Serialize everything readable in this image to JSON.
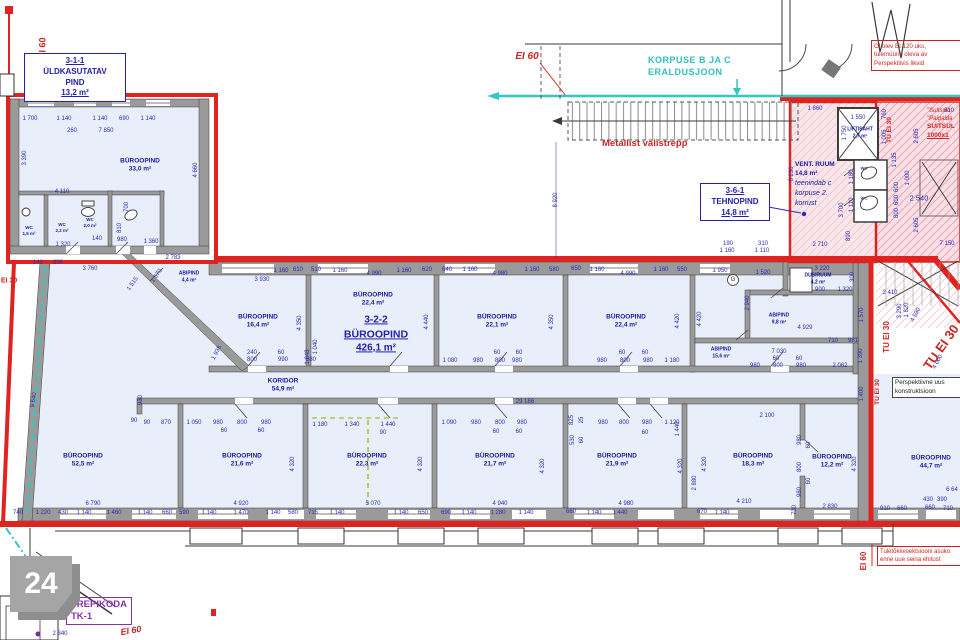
{
  "drawing": {
    "sheet_number": "24"
  },
  "boxed": {
    "uld": [
      "3-1-1",
      "ÜLDKASUTATAV",
      "PIND",
      "13,2 m²"
    ],
    "teh": [
      "3-6-1",
      "TEHNOPIND",
      "14,8 m²"
    ]
  },
  "big_label": {
    "code": "3-2-2",
    "name": "BÜROOPIND",
    "area": "426,1 m²"
  },
  "vent": {
    "name": "VENT. RUUM",
    "area": "14,8 m²",
    "notes": [
      "teenindab c",
      "korpuse 2.",
      "korrust"
    ]
  },
  "notes": {
    "korpuse": [
      "KORPUSE B JA C",
      "ERALDUSJOON"
    ],
    "metallist": "Metallist välistrepp",
    "ololev": [
      "Ol olev EI 120 uks,",
      "tulemüüris oleva av",
      "Perspektiivis likvid"
    ],
    "suitsu": [
      "\"Suitsulu",
      "\"Paigalda",
      "SUITSUL",
      "1000x1"
    ],
    "persp": [
      "Perspektiivne uus",
      "konstruktsioon"
    ],
    "tuletokke": [
      "Tuletõkkesektsiooni asuko",
      "enne uue seina ehitust"
    ],
    "trepikoda": [
      "TREPIKODA",
      "TK-1"
    ]
  },
  "rooms": [
    {
      "name": "BÜROOPIND",
      "area": "33,0 m²",
      "x": 140,
      "y": 166
    },
    {
      "name": "WC",
      "area": "1,5 m²",
      "x": 29,
      "y": 231,
      "f": 4.5
    },
    {
      "name": "WC",
      "area": "2,2 m²",
      "x": 62,
      "y": 228,
      "f": 4.5
    },
    {
      "name": "WC",
      "area": "2,0 m²",
      "x": 90,
      "y": 223,
      "f": 4.5
    },
    {
      "name": "ABIPIND",
      "area": "4,4 m²",
      "x": 189,
      "y": 277,
      "f": 5
    },
    {
      "name": "BÜROOPIND",
      "area": "16,4 m²",
      "x": 258,
      "y": 322
    },
    {
      "name": "BÜROOPIND",
      "area": "22,4 m²",
      "x": 373,
      "y": 300
    },
    {
      "name": "BÜROOPIND",
      "area": "22,1 m²",
      "x": 497,
      "y": 322
    },
    {
      "name": "BÜROOPIND",
      "area": "22,4 m²",
      "x": 626,
      "y": 322
    },
    {
      "name": "DUSIRUUM",
      "area": "4,2 m²",
      "x": 818,
      "y": 279,
      "f": 5
    },
    {
      "name": "ABIPIND",
      "area": "9,8 m²",
      "x": 779,
      "y": 319,
      "f": 5
    },
    {
      "name": "ABIPIND",
      "area": "15,6 m²",
      "x": 721,
      "y": 353,
      "f": 5
    },
    {
      "name": "KORIDOR",
      "area": "54,9 m²",
      "x": 283,
      "y": 386
    },
    {
      "name": "BÜROOPIND",
      "area": "52,5 m²",
      "x": 83,
      "y": 461
    },
    {
      "name": "BÜROOPIND",
      "area": "21,6 m²",
      "x": 242,
      "y": 461
    },
    {
      "name": "BÜROOPIND",
      "area": "22,3 m²",
      "x": 367,
      "y": 461
    },
    {
      "name": "BÜROOPIND",
      "area": "21,7 m²",
      "x": 495,
      "y": 461
    },
    {
      "name": "BÜROOPIND",
      "area": "21,9 m²",
      "x": 617,
      "y": 461
    },
    {
      "name": "BÜROOPIND",
      "area": "18,3 m²",
      "x": 753,
      "y": 461
    },
    {
      "name": "BÜROOPIND",
      "area": "12,2 m²",
      "x": 832,
      "y": 462
    },
    {
      "name": "BÜROOPIND",
      "area": "44,7 m²",
      "x": 931,
      "y": 463
    },
    {
      "name": "LIFTISAHT",
      "area": "2,7 m²",
      "x": 860,
      "y": 133,
      "f": 5
    },
    {
      "name": "WC",
      "area": "",
      "x": 864,
      "y": 168,
      "f": 4
    },
    {
      "name": "WC",
      "area": "",
      "x": 864,
      "y": 198,
      "f": 4
    }
  ],
  "fire_labels": [
    {
      "t": "EI 60",
      "x": 43,
      "y": 48,
      "r": -90,
      "f": 9
    },
    {
      "t": "EI 30",
      "x": 9,
      "y": 281,
      "f": 7
    },
    {
      "t": "EI 60",
      "x": 527,
      "y": 57,
      "f": 10,
      "i": 1
    },
    {
      "t": "TU EI 30",
      "x": 890,
      "y": 130,
      "r": -90,
      "f": 6.5
    },
    {
      "t": "TU EI 30",
      "x": 887,
      "y": 337,
      "r": -90,
      "f": 8
    },
    {
      "t": "TU EI 30",
      "x": 878,
      "y": 392,
      "r": -90,
      "f": 6.5
    },
    {
      "t": "TU EI 30",
      "x": 941,
      "y": 347,
      "r": -55,
      "f": 13
    },
    {
      "t": "EI 60",
      "x": 864,
      "y": 561,
      "r": -90,
      "f": 8
    },
    {
      "t": "EI 60",
      "x": 131,
      "y": 631,
      "r": -10,
      "f": 9,
      "i": 1
    }
  ],
  "dimensions": [
    {
      "t": "1 700",
      "x": 30,
      "y": 119
    },
    {
      "t": "1 140",
      "x": 64,
      "y": 119
    },
    {
      "t": "1 140",
      "x": 100,
      "y": 119
    },
    {
      "t": "690",
      "x": 124,
      "y": 119
    },
    {
      "t": "1 140",
      "x": 148,
      "y": 119
    },
    {
      "t": "260",
      "x": 72,
      "y": 131
    },
    {
      "t": "7 850",
      "x": 106,
      "y": 131
    },
    {
      "t": "3 390",
      "x": 25,
      "y": 158,
      "r": -90
    },
    {
      "t": "4 660",
      "x": 196,
      "y": 170,
      "r": -90
    },
    {
      "t": "4 110",
      "x": 62,
      "y": 192
    },
    {
      "t": "700",
      "x": 127,
      "y": 207,
      "r": -90
    },
    {
      "t": "810",
      "x": 120,
      "y": 228,
      "r": -90
    },
    {
      "t": "140",
      "x": 97,
      "y": 239
    },
    {
      "t": "980",
      "x": 122,
      "y": 240
    },
    {
      "t": "1 360",
      "x": 151,
      "y": 242
    },
    {
      "t": "1 320",
      "x": 63,
      "y": 245
    },
    {
      "t": "890",
      "x": 58,
      "y": 263
    },
    {
      "t": "140",
      "x": 38,
      "y": 263
    },
    {
      "t": "2 783",
      "x": 173,
      "y": 258
    },
    {
      "t": "3 760",
      "x": 90,
      "y": 269
    },
    {
      "t": "1 515",
      "x": 133,
      "y": 284,
      "r": -55
    },
    {
      "t": "1 570",
      "x": 157,
      "y": 276,
      "r": -55
    },
    {
      "t": "1 938",
      "x": 217,
      "y": 353,
      "r": -62
    },
    {
      "t": "9 640",
      "x": 34,
      "y": 400,
      "r": -82
    },
    {
      "t": "930",
      "x": 141,
      "y": 400,
      "r": -90
    },
    {
      "t": "3 930",
      "x": 262,
      "y": 280
    },
    {
      "t": "1 160",
      "x": 281,
      "y": 271
    },
    {
      "t": "610",
      "x": 298,
      "y": 270
    },
    {
      "t": "510",
      "x": 316,
      "y": 270
    },
    {
      "t": "1 160",
      "x": 340,
      "y": 271
    },
    {
      "t": "4 990",
      "x": 374,
      "y": 274
    },
    {
      "t": "1 160",
      "x": 404,
      "y": 271
    },
    {
      "t": "620",
      "x": 427,
      "y": 270
    },
    {
      "t": "640",
      "x": 447,
      "y": 270
    },
    {
      "t": "1 160",
      "x": 470,
      "y": 270
    },
    {
      "t": "4 980",
      "x": 500,
      "y": 274
    },
    {
      "t": "1 160",
      "x": 532,
      "y": 270
    },
    {
      "t": "580",
      "x": 554,
      "y": 270
    },
    {
      "t": "650",
      "x": 576,
      "y": 269
    },
    {
      "t": "1 160",
      "x": 597,
      "y": 270
    },
    {
      "t": "4 990",
      "x": 628,
      "y": 274
    },
    {
      "t": "1 160",
      "x": 661,
      "y": 270
    },
    {
      "t": "550",
      "x": 682,
      "y": 270
    },
    {
      "t": "1 950",
      "x": 720,
      "y": 271
    },
    {
      "t": "1 520",
      "x": 763,
      "y": 273
    },
    {
      "t": "3 220",
      "x": 822,
      "y": 269
    },
    {
      "t": "300",
      "x": 853,
      "y": 277,
      "r": -90
    },
    {
      "t": "900",
      "x": 820,
      "y": 290
    },
    {
      "t": "1 320",
      "x": 845,
      "y": 290
    },
    {
      "t": "2 940",
      "x": 748,
      "y": 303,
      "r": -90
    },
    {
      "t": "190",
      "x": 728,
      "y": 244
    },
    {
      "t": "310",
      "x": 763,
      "y": 244
    },
    {
      "t": "1 160",
      "x": 727,
      "y": 251
    },
    {
      "t": "1 110",
      "x": 762,
      "y": 251
    },
    {
      "t": "4 350",
      "x": 300,
      "y": 323,
      "r": -90
    },
    {
      "t": "4 440",
      "x": 427,
      "y": 322,
      "r": -90
    },
    {
      "t": "4 350",
      "x": 552,
      "y": 322,
      "r": -90
    },
    {
      "t": "4 420",
      "x": 678,
      "y": 321,
      "r": -90
    },
    {
      "t": "4 420",
      "x": 700,
      "y": 319,
      "r": -90
    },
    {
      "t": "240",
      "x": 252,
      "y": 353
    },
    {
      "t": "60",
      "x": 281,
      "y": 353
    },
    {
      "t": "800",
      "x": 252,
      "y": 360
    },
    {
      "t": "990",
      "x": 283,
      "y": 360
    },
    {
      "t": "580",
      "x": 311,
      "y": 360
    },
    {
      "t": "1 040",
      "x": 316,
      "y": 347,
      "r": -90
    },
    {
      "t": "1 048",
      "x": 308,
      "y": 357,
      "r": -90
    },
    {
      "t": "1 080",
      "x": 450,
      "y": 361
    },
    {
      "t": "980",
      "x": 478,
      "y": 361
    },
    {
      "t": "800",
      "x": 500,
      "y": 361
    },
    {
      "t": "980",
      "x": 517,
      "y": 361
    },
    {
      "t": "60",
      "x": 497,
      "y": 353
    },
    {
      "t": "60",
      "x": 519,
      "y": 353
    },
    {
      "t": "980",
      "x": 602,
      "y": 361
    },
    {
      "t": "800",
      "x": 625,
      "y": 361
    },
    {
      "t": "980",
      "x": 648,
      "y": 361
    },
    {
      "t": "1 180",
      "x": 672,
      "y": 361
    },
    {
      "t": "60",
      "x": 622,
      "y": 353
    },
    {
      "t": "60",
      "x": 645,
      "y": 353
    },
    {
      "t": "4 929",
      "x": 805,
      "y": 328
    },
    {
      "t": "710",
      "x": 833,
      "y": 341
    },
    {
      "t": "981",
      "x": 853,
      "y": 341
    },
    {
      "t": "7 030",
      "x": 779,
      "y": 352
    },
    {
      "t": "60",
      "x": 776,
      "y": 359
    },
    {
      "t": "60",
      "x": 799,
      "y": 359
    },
    {
      "t": "980",
      "x": 755,
      "y": 366
    },
    {
      "t": "800",
      "x": 778,
      "y": 366
    },
    {
      "t": "980",
      "x": 801,
      "y": 366
    },
    {
      "t": "2 062",
      "x": 840,
      "y": 366
    },
    {
      "t": "2 410",
      "x": 890,
      "y": 293
    },
    {
      "t": "3 290",
      "x": 900,
      "y": 311,
      "r": -90
    },
    {
      "t": "1 820",
      "x": 907,
      "y": 310,
      "r": -90
    },
    {
      "t": "4 590",
      "x": 916,
      "y": 315,
      "r": -62
    },
    {
      "t": "4 000",
      "x": 938,
      "y": 362,
      "r": -62
    },
    {
      "t": "1 570",
      "x": 862,
      "y": 315,
      "r": -90
    },
    {
      "t": "1 390",
      "x": 861,
      "y": 356,
      "r": -90
    },
    {
      "t": "1 400",
      "x": 862,
      "y": 394,
      "r": -90
    },
    {
      "t": "7 150",
      "x": 947,
      "y": 244
    },
    {
      "t": "2 540",
      "x": 919,
      "y": 198,
      "f": 7.5
    },
    {
      "t": "2 605",
      "x": 917,
      "y": 136,
      "r": -90
    },
    {
      "t": "2 605",
      "x": 917,
      "y": 225,
      "r": -90
    },
    {
      "t": "1 000",
      "x": 908,
      "y": 178,
      "r": -90
    },
    {
      "t": "760",
      "x": 885,
      "y": 114,
      "r": -90
    },
    {
      "t": "1 005",
      "x": 885,
      "y": 137,
      "r": -90
    },
    {
      "t": "1 135",
      "x": 895,
      "y": 160,
      "r": -90
    },
    {
      "t": "600",
      "x": 897,
      "y": 187,
      "r": -90
    },
    {
      "t": "600",
      "x": 897,
      "y": 200,
      "r": -90
    },
    {
      "t": "800",
      "x": 897,
      "y": 213,
      "r": -90
    },
    {
      "t": "610",
      "x": 949,
      "y": 111
    },
    {
      "t": "1 860",
      "x": 815,
      "y": 109
    },
    {
      "t": "1 550",
      "x": 858,
      "y": 118
    },
    {
      "t": "1 750",
      "x": 845,
      "y": 133,
      "r": -90
    },
    {
      "t": "6 230",
      "x": 792,
      "y": 174,
      "r": -90
    },
    {
      "t": "2 710",
      "x": 820,
      "y": 245
    },
    {
      "t": "3 700",
      "x": 842,
      "y": 210,
      "r": -90
    },
    {
      "t": "1 180",
      "x": 852,
      "y": 177,
      "r": -90
    },
    {
      "t": "1 110",
      "x": 852,
      "y": 205,
      "r": -90
    },
    {
      "t": "890",
      "x": 849,
      "y": 236,
      "r": -90
    },
    {
      "t": "8 920",
      "x": 556,
      "y": 200,
      "r": -90
    },
    {
      "t": "29 166",
      "x": 525,
      "y": 402
    },
    {
      "t": "90",
      "x": 134,
      "y": 421
    },
    {
      "t": "90",
      "x": 147,
      "y": 423
    },
    {
      "t": "870",
      "x": 166,
      "y": 423
    },
    {
      "t": "1 050",
      "x": 194,
      "y": 423
    },
    {
      "t": "980",
      "x": 218,
      "y": 423
    },
    {
      "t": "800",
      "x": 242,
      "y": 423
    },
    {
      "t": "980",
      "x": 266,
      "y": 423
    },
    {
      "t": "60",
      "x": 224,
      "y": 431
    },
    {
      "t": "60",
      "x": 261,
      "y": 431
    },
    {
      "t": "1 180",
      "x": 320,
      "y": 425
    },
    {
      "t": "1 340",
      "x": 352,
      "y": 425
    },
    {
      "t": "1 440",
      "x": 388,
      "y": 425
    },
    {
      "t": "90",
      "x": 383,
      "y": 433
    },
    {
      "t": "1 090",
      "x": 449,
      "y": 423
    },
    {
      "t": "980",
      "x": 476,
      "y": 423
    },
    {
      "t": "800",
      "x": 500,
      "y": 423
    },
    {
      "t": "980",
      "x": 522,
      "y": 423
    },
    {
      "t": "60",
      "x": 496,
      "y": 432
    },
    {
      "t": "60",
      "x": 519,
      "y": 432
    },
    {
      "t": "825",
      "x": 572,
      "y": 420,
      "r": -90
    },
    {
      "t": "25",
      "x": 582,
      "y": 420,
      "r": -90
    },
    {
      "t": "530",
      "x": 573,
      "y": 440,
      "r": -90
    },
    {
      "t": "60",
      "x": 582,
      "y": 440,
      "r": -90
    },
    {
      "t": "980",
      "x": 603,
      "y": 423
    },
    {
      "t": "800",
      "x": 624,
      "y": 423
    },
    {
      "t": "980",
      "x": 647,
      "y": 423
    },
    {
      "t": "60",
      "x": 645,
      "y": 433
    },
    {
      "t": "1 120",
      "x": 672,
      "y": 423
    },
    {
      "t": "1 440",
      "x": 678,
      "y": 429,
      "r": -90
    },
    {
      "t": "2 100",
      "x": 767,
      "y": 416
    },
    {
      "t": "980",
      "x": 800,
      "y": 440,
      "r": -90
    },
    {
      "t": "60",
      "x": 809,
      "y": 445,
      "r": -90
    },
    {
      "t": "800",
      "x": 800,
      "y": 467,
      "r": -90
    },
    {
      "t": "60",
      "x": 809,
      "y": 481,
      "r": -90
    },
    {
      "t": "980",
      "x": 800,
      "y": 492,
      "r": -90
    },
    {
      "t": "4 320",
      "x": 293,
      "y": 464,
      "r": -90
    },
    {
      "t": "4 320",
      "x": 421,
      "y": 464,
      "r": -90
    },
    {
      "t": "4 320",
      "x": 543,
      "y": 466,
      "r": -90
    },
    {
      "t": "4 320",
      "x": 681,
      "y": 466,
      "r": -90
    },
    {
      "t": "4 320",
      "x": 705,
      "y": 464,
      "r": -90
    },
    {
      "t": "2 880",
      "x": 695,
      "y": 483,
      "r": -90
    },
    {
      "t": "4 320",
      "x": 855,
      "y": 464,
      "r": -90
    },
    {
      "t": "730",
      "x": 795,
      "y": 510,
      "r": -90
    },
    {
      "t": "6 790",
      "x": 93,
      "y": 504
    },
    {
      "t": "4 920",
      "x": 241,
      "y": 504
    },
    {
      "t": "5 070",
      "x": 373,
      "y": 504
    },
    {
      "t": "4 940",
      "x": 500,
      "y": 504
    },
    {
      "t": "4 980",
      "x": 626,
      "y": 504
    },
    {
      "t": "4 210",
      "x": 744,
      "y": 502
    },
    {
      "t": "2 830",
      "x": 830,
      "y": 507
    },
    {
      "t": "740",
      "x": 18,
      "y": 513
    },
    {
      "t": "1 220",
      "x": 43,
      "y": 513
    },
    {
      "t": "430",
      "x": 63,
      "y": 513
    },
    {
      "t": "1 140",
      "x": 84,
      "y": 513
    },
    {
      "t": "1 460",
      "x": 114,
      "y": 513
    },
    {
      "t": "1 140",
      "x": 145,
      "y": 513
    },
    {
      "t": "660",
      "x": 167,
      "y": 513
    },
    {
      "t": "590",
      "x": 184,
      "y": 513
    },
    {
      "t": "1 140",
      "x": 209,
      "y": 513
    },
    {
      "t": "1 470",
      "x": 241,
      "y": 513
    },
    {
      "t": "1 140",
      "x": 273,
      "y": 513
    },
    {
      "t": "580",
      "x": 293,
      "y": 513
    },
    {
      "t": "715",
      "x": 313,
      "y": 513
    },
    {
      "t": "1 140",
      "x": 337,
      "y": 513
    },
    {
      "t": "1 140",
      "x": 401,
      "y": 513
    },
    {
      "t": "650",
      "x": 423,
      "y": 513
    },
    {
      "t": "690",
      "x": 446,
      "y": 513
    },
    {
      "t": "1 140",
      "x": 469,
      "y": 513
    },
    {
      "t": "1 280",
      "x": 498,
      "y": 513
    },
    {
      "t": "1 140",
      "x": 526,
      "y": 513
    },
    {
      "t": "660",
      "x": 571,
      "y": 512
    },
    {
      "t": "1 140",
      "x": 594,
      "y": 513
    },
    {
      "t": "1 440",
      "x": 620,
      "y": 513
    },
    {
      "t": "670",
      "x": 702,
      "y": 512
    },
    {
      "t": "1 140",
      "x": 722,
      "y": 513
    },
    {
      "t": "910",
      "x": 885,
      "y": 509
    },
    {
      "t": "660",
      "x": 902,
      "y": 509
    },
    {
      "t": "430",
      "x": 928,
      "y": 500
    },
    {
      "t": "390",
      "x": 942,
      "y": 500
    },
    {
      "t": "660",
      "x": 930,
      "y": 508
    },
    {
      "t": "710",
      "x": 948,
      "y": 509
    },
    {
      "t": "6 64",
      "x": 952,
      "y": 490
    },
    {
      "t": "2 340",
      "x": 60,
      "y": 634
    },
    {
      "t": "G",
      "x": 733,
      "y": 280,
      "f": 6,
      "c": "#333333"
    }
  ]
}
